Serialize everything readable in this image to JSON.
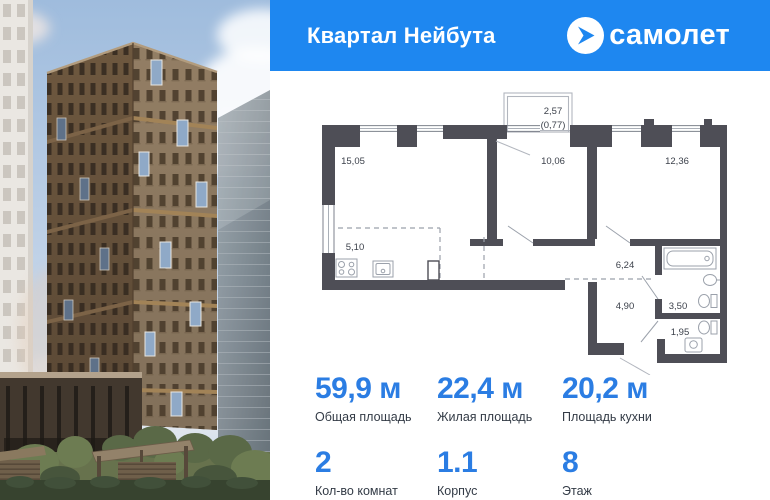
{
  "header": {
    "title": "Квартал Нейбута",
    "brand": "самолет",
    "bg_color": "#1e87f0"
  },
  "floor_plan": {
    "rooms": [
      {
        "id": "living",
        "area": "15,05"
      },
      {
        "id": "bedroom-1",
        "area": "10,06"
      },
      {
        "id": "bedroom-2",
        "area": "12,36"
      },
      {
        "id": "kitchen",
        "area": "5,10"
      },
      {
        "id": "corridor",
        "area": "6,24"
      },
      {
        "id": "hallway",
        "area": "4,90"
      },
      {
        "id": "bathroom",
        "area": "3,50"
      },
      {
        "id": "wc",
        "area": "1,95"
      }
    ],
    "balcony": {
      "area": "2,57",
      "reduced_area": "(0,77)"
    },
    "wall_color": "#4e4e56"
  },
  "stats": {
    "accent_color": "#2b7de3",
    "row1": [
      {
        "value": "59,9 м",
        "label": "Общая площадь"
      },
      {
        "value": "22,4 м",
        "label": "Жилая площадь"
      },
      {
        "value": "20,2 м",
        "label": "Площадь кухни"
      }
    ],
    "row2": [
      {
        "value": "2",
        "label": "Кол-во комнат"
      },
      {
        "value": "1.1",
        "label": "Корпус"
      },
      {
        "value": "8",
        "label": "Этаж"
      }
    ]
  }
}
